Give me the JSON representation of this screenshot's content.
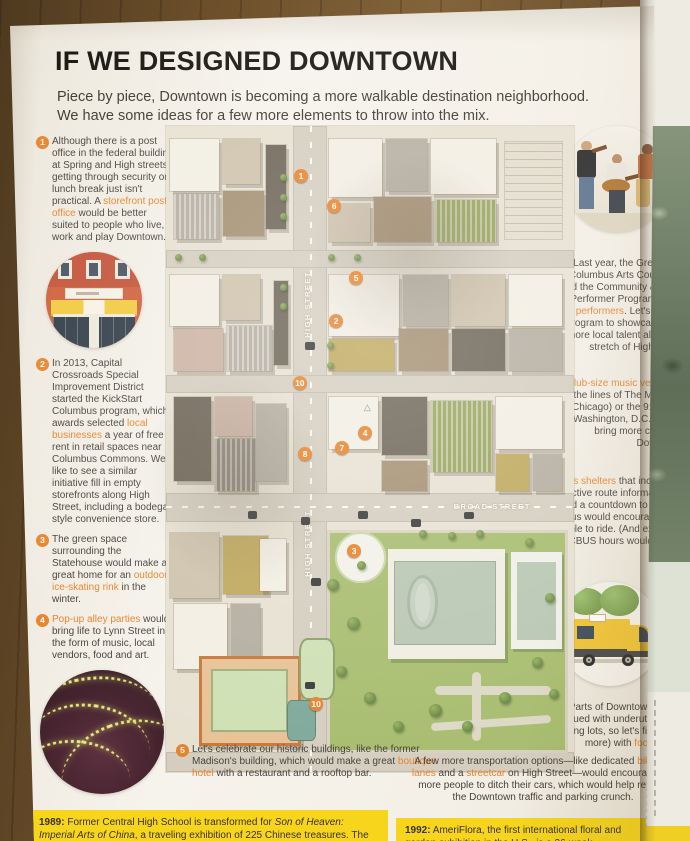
{
  "magazine": {
    "title": "IF WE DESIGNED DOWNTOWN",
    "intro": "Piece by piece, Downtown is becoming a more walkable destination neighborhood. We have some ideas for a few more elements to throw into the mix."
  },
  "accent_color": "#e8832c",
  "callouts_left": [
    {
      "num": "1",
      "segments": [
        {
          "t": "Although there is a post office in the federal building at Spring and High streets, getting through security on lunch break just isn't practical. A "
        },
        {
          "t": "storefront post office",
          "hl": true
        },
        {
          "t": " would be better suited to people who live, work and play Downtown."
        }
      ]
    },
    {
      "num": "2",
      "segments": [
        {
          "t": "In 2013, Capital Crossroads Special Improvement District started the KickStart Columbus program, which awards selected "
        },
        {
          "t": "local businesses",
          "hl": true
        },
        {
          "t": " a year of free rent in retail spaces near Columbus Commons. We'd like to see a similar initiative fill in empty storefronts along High Street, including a bodega-style convenience store."
        }
      ]
    },
    {
      "num": "3",
      "segments": [
        {
          "t": "The green space surrounding the Statehouse would make a great home for an "
        },
        {
          "t": "outdoor ice-skating rink",
          "hl": true
        },
        {
          "t": " in the winter."
        }
      ]
    },
    {
      "num": "4",
      "segments": [
        {
          "t": "Pop-up alley parties",
          "hl": true
        },
        {
          "t": " would bring life to Lynn Street in the form of music, local vendors, food and art."
        }
      ]
    }
  ],
  "callouts_right": [
    {
      "num": "6",
      "segments": [
        {
          "t": "Last year, the Greater Columbus Arts Council started the Community & Street Performer Program to pay "
        },
        {
          "t": "street performers",
          "hl": true
        },
        {
          "t": ". Let's expand the program to showcase even more local talent along this stretch of High Street."
        }
      ]
    },
    {
      "num": "7",
      "segments": [
        {
          "t": "A "
        },
        {
          "t": "club-size music venue,",
          "hl": true
        },
        {
          "t": " along the lines of The Metro (Chicago) or the 9:30 Club (Washington, D.C.), would bring more culture to Downtown."
        }
      ]
    },
    {
      "num": "8",
      "segments": [
        {
          "t": "Bus shelters",
          "hl": true
        },
        {
          "t": " that include interactive route information and a countdown to the next bus would encourage more people to ride. (And extending CBUS hours wouldn't hurt, either.)"
        }
      ]
    },
    {
      "num": "9",
      "segments": [
        {
          "t": "Parts of Downtown are plagued with underutilized parking lots, so let's fill one (or more) with "
        },
        {
          "t": "food trucks",
          "hl": true
        },
        {
          "t": "."
        }
      ]
    }
  ],
  "callout_bottom_left": {
    "num": "5",
    "segments": [
      {
        "t": "Let's celebrate our historic buildings, like the former Madison's building, which would make a great "
      },
      {
        "t": "boutique hotel",
        "hl": true
      },
      {
        "t": " with a restaurant and a rooftop bar."
      }
    ]
  },
  "callout_bottom_right": {
    "num": "10",
    "segments": [
      {
        "t": "A few more transportation options—like dedicated "
      },
      {
        "t": "bike lanes",
        "hl": true
      },
      {
        "t": " and a "
      },
      {
        "t": "streetcar",
        "hl": true
      },
      {
        "t": " on High Street—would encourage more people to ditch their cars, which would help reduce the Downtown traffic and parking crunch."
      }
    ]
  },
  "map": {
    "high_street_label": "HIGH STREET",
    "broad_street_label": "BROAD STREET",
    "badges": [
      {
        "n": "1",
        "x": 33.1,
        "y": 7.7
      },
      {
        "n": "6",
        "x": 41.2,
        "y": 12.4
      },
      {
        "n": "5",
        "x": 46.6,
        "y": 23.5
      },
      {
        "n": "2",
        "x": 41.7,
        "y": 30.2
      },
      {
        "n": "10",
        "x": 32.8,
        "y": 39.8
      },
      {
        "n": "4",
        "x": 48.8,
        "y": 47.5
      },
      {
        "n": "7",
        "x": 43.1,
        "y": 49.8
      },
      {
        "n": "8",
        "x": 34.1,
        "y": 50.8
      },
      {
        "n": "3",
        "x": 46.1,
        "y": 65.8
      },
      {
        "n": "10",
        "x": 36.8,
        "y": 89.5
      }
    ]
  },
  "timeline": {
    "left_year": "1989:",
    "left_segments": [
      {
        "t": " Former Central High School is transformed for "
      },
      {
        "t": "Son of Heaven: Imperial Arts of China",
        "it": true
      },
      {
        "t": ", a traveling exhibition of 225 Chinese treasures. The show loses money and receives public funding to break even."
      }
    ],
    "right_year": "1992:",
    "right_text": " AmeriFlora, the first international floral and garden exhibition in the U.S., is a 26-week exhibition that"
  }
}
